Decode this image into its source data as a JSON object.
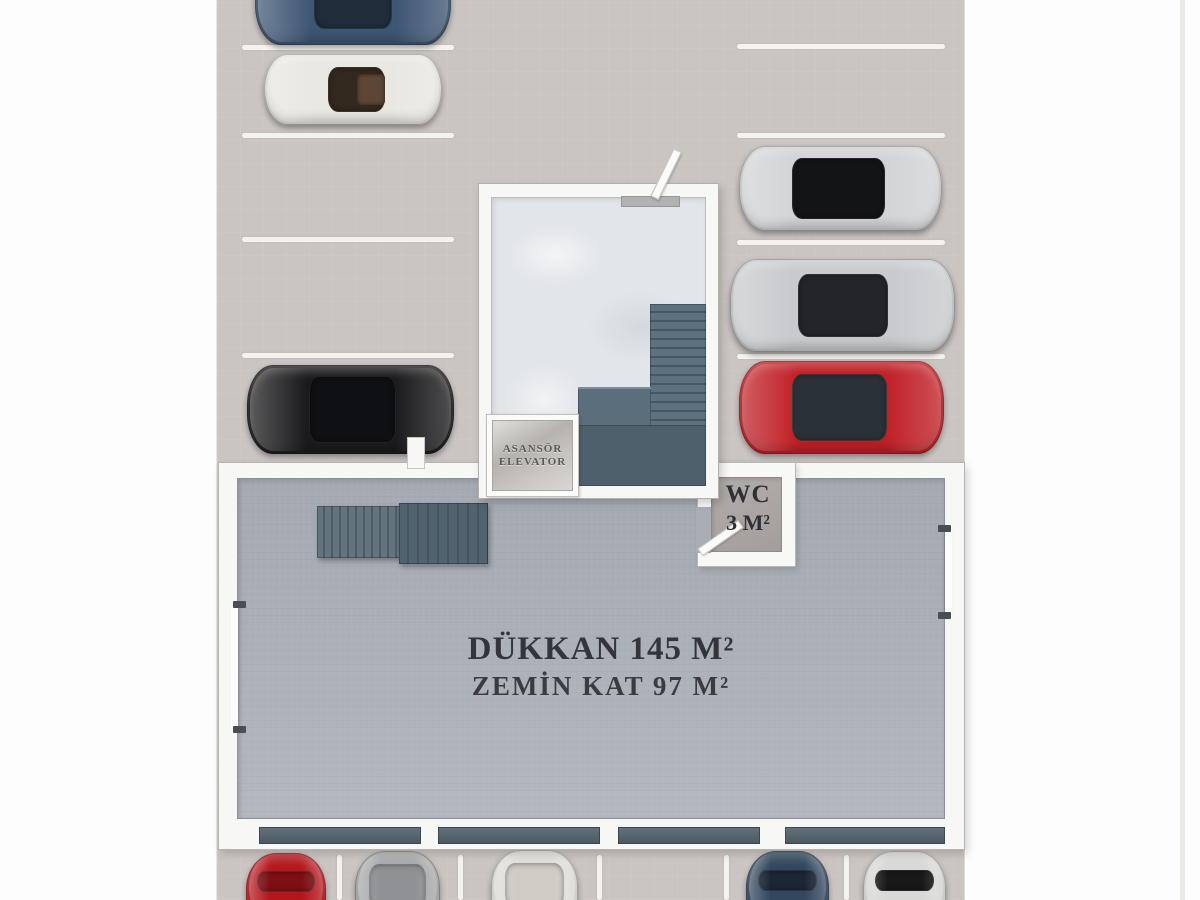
{
  "labels": {
    "shop_line1": "DÜKKAN 145 M²",
    "shop_line2": "ZEMİN KAT 97 M²",
    "wc_line1": "WC",
    "wc_line2": "3 M²",
    "elevator_line1": "ASANSÖR",
    "elevator_line2": "ELEVATOR"
  },
  "colors": {
    "lot_background": "#cbc5c2",
    "parking_line": "#f5f3f0",
    "shop_floor": "#abafb7",
    "wall_white": "#f7f7f6",
    "stair_slate": "#5d7280",
    "landing_slate": "#4d606b",
    "storefront_window": "#4a5961",
    "wc_floor": "#aaa5a2",
    "marble_floor": "#e2e5e9",
    "elevator_metal": "#c9c6c2",
    "label_text": "#33353b"
  },
  "parking": {
    "lines": [
      {
        "name": "parking-line-left-1",
        "x": 242,
        "y": 45,
        "w": 212,
        "h": 5
      },
      {
        "name": "parking-line-left-2",
        "x": 242,
        "y": 133,
        "w": 212,
        "h": 5
      },
      {
        "name": "parking-line-left-3",
        "x": 242,
        "y": 237,
        "w": 212,
        "h": 5
      },
      {
        "name": "parking-line-left-4",
        "x": 242,
        "y": 353,
        "w": 212,
        "h": 5
      },
      {
        "name": "parking-line-right-1",
        "x": 737,
        "y": 44,
        "w": 208,
        "h": 5
      },
      {
        "name": "parking-line-right-2",
        "x": 737,
        "y": 133,
        "w": 208,
        "h": 5
      },
      {
        "name": "parking-line-right-3",
        "x": 737,
        "y": 240,
        "w": 208,
        "h": 5
      },
      {
        "name": "parking-line-right-4",
        "x": 737,
        "y": 354,
        "w": 208,
        "h": 5
      },
      {
        "name": "parking-line-bottom-1",
        "x": 337,
        "y": 855,
        "w": 5,
        "h": 45
      },
      {
        "name": "parking-line-bottom-2",
        "x": 458,
        "y": 855,
        "w": 5,
        "h": 45
      },
      {
        "name": "parking-line-bottom-3",
        "x": 597,
        "y": 855,
        "w": 5,
        "h": 45
      },
      {
        "name": "parking-line-bottom-4",
        "x": 724,
        "y": 855,
        "w": 5,
        "h": 45
      },
      {
        "name": "parking-line-bottom-5",
        "x": 844,
        "y": 855,
        "w": 5,
        "h": 45
      }
    ],
    "cars": [
      {
        "name": "car-darkblue-sedan-top",
        "kind": "sedan",
        "x": 255,
        "y": -52,
        "w": 196,
        "h": 97,
        "body": "#3d5673",
        "glass": "#1f2d3b"
      },
      {
        "name": "car-white-convertible",
        "kind": "convertible",
        "x": 264,
        "y": 54,
        "w": 178,
        "h": 71,
        "body": "#e9e7e2",
        "glass": "#33281e"
      },
      {
        "name": "car-black-suv",
        "kind": "suv",
        "x": 247,
        "y": 365,
        "w": 207,
        "h": 89,
        "body": "#1b1b1d",
        "glass": "#0f1013"
      },
      {
        "name": "car-silver-coupe",
        "kind": "sport",
        "x": 739,
        "y": 146,
        "w": 203,
        "h": 85,
        "body": "#d2d3d5",
        "glass": "#131415"
      },
      {
        "name": "car-silver-sedan",
        "kind": "sedan",
        "x": 730,
        "y": 259,
        "w": 225,
        "h": 93,
        "body": "#c8cacd",
        "glass": "#232528"
      },
      {
        "name": "car-red-coupe",
        "kind": "sport",
        "x": 739,
        "y": 361,
        "w": 205,
        "h": 93,
        "body": "#bf1f25",
        "glass": "#2b3237"
      },
      {
        "name": "car-red-front",
        "kind": "front",
        "x": 246,
        "y": 853,
        "w": 80,
        "h": 70,
        "body": "#b5161c",
        "glass": "#7e0f14"
      },
      {
        "name": "car-silver-covered-front",
        "kind": "front-covered",
        "x": 355,
        "y": 851,
        "w": 85,
        "h": 72,
        "body": "#a7a8aa",
        "glass": "#909194"
      },
      {
        "name": "car-cream-covered-front",
        "kind": "front-covered",
        "x": 491,
        "y": 850,
        "w": 87,
        "h": 73,
        "body": "#dfddd6",
        "glass": "#cfccc4"
      },
      {
        "name": "car-darkblue-front",
        "kind": "front",
        "x": 746,
        "y": 851,
        "w": 83,
        "h": 72,
        "body": "#33475f",
        "glass": "#1b2735"
      },
      {
        "name": "car-white-front",
        "kind": "front",
        "x": 863,
        "y": 851,
        "w": 83,
        "h": 72,
        "body": "#d8d8d6",
        "glass": "#181818"
      }
    ]
  },
  "shop": {
    "windows": [
      {
        "name": "storefront-window-1",
        "x": 40,
        "w": 160
      },
      {
        "name": "storefront-window-2",
        "x": 219,
        "w": 160
      },
      {
        "name": "storefront-window-3",
        "x": 399,
        "w": 140
      },
      {
        "name": "storefront-window-4",
        "x": 566,
        "w": 158
      }
    ],
    "wall_ticks": [
      {
        "name": "wall-tick-left-top",
        "x": 14,
        "y": 138
      },
      {
        "name": "wall-tick-left-bottom",
        "x": 14,
        "y": 263
      },
      {
        "name": "wall-tick-right-top",
        "x": 719,
        "y": 62
      },
      {
        "name": "wall-tick-right-bottom",
        "x": 719,
        "y": 149
      }
    ]
  }
}
